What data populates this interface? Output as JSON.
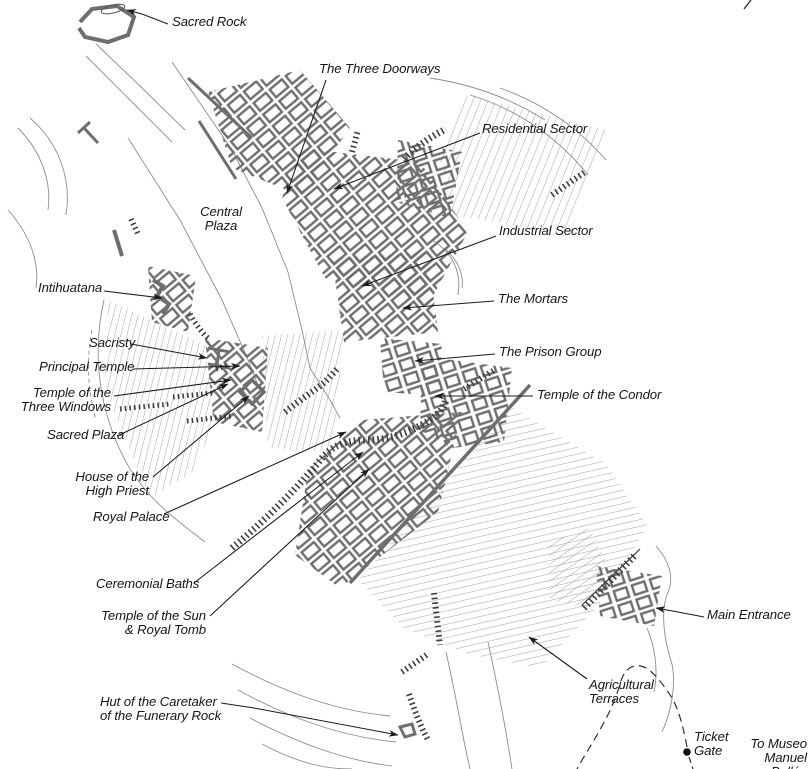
{
  "map": {
    "labels": {
      "sacred_rock": "Sacred Rock",
      "three_doorways": "The Three Doorways",
      "residential_sector": "Residential Sector",
      "industrial_sector": "Industrial Sector",
      "the_mortars": "The Mortars",
      "prison_group": "The Prison Group",
      "temple_of_condor": "Temple of the Condor",
      "central_plaza": "Central\nPlaza",
      "intihuatana": "Intihuatana",
      "sacristy": "Sacristy",
      "principal_temple": "Principal Temple",
      "temple_three_windows": "Temple of the\nThree Windows",
      "sacred_plaza": "Sacred Plaza",
      "house_high_priest": "House of the\nHigh Priest",
      "royal_palace": "Royal Palace",
      "ceremonial_baths": "Ceremonial Baths",
      "temple_sun_tomb": "Temple of the Sun\n& Royal Tomb",
      "caretaker_hut": "Hut of the Caretaker\nof the Funerary Rock",
      "agricultural_terraces": "Agricultural\nTerraces",
      "main_entrance": "Main Entrance",
      "ticket_gate": "Ticket\nGate",
      "to_museo": "To Museo\nManuel\nBallón"
    },
    "colors": {
      "wall_gray": "#6e6e6e",
      "terrain_gray": "#8d8d8d",
      "ink": "#1c1c1c"
    }
  }
}
